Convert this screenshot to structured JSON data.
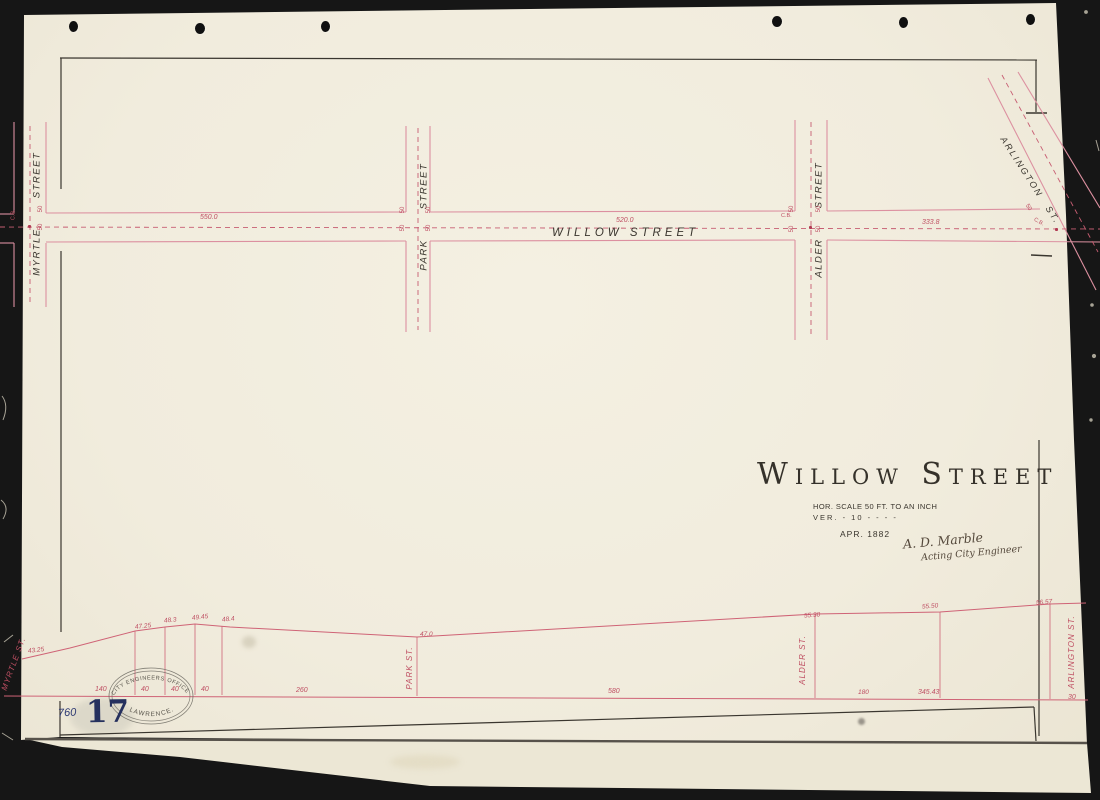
{
  "title_block": {
    "title": "Willow Street",
    "scale_hor": "HOR. SCALE 50 FT. TO AN INCH",
    "scale_ver": "VER.  -  10  -  -  -  -",
    "date": "APR. 1882",
    "signature": "A. D. Marble",
    "signature_role": "Acting City Engineer"
  },
  "plan": {
    "main_street": "WILLOW STREET",
    "cross_streets": [
      "MYRTLE STREET",
      "PARK STREET",
      "ALDER STREET",
      "ARLINGTON ST."
    ],
    "measurements": [
      "550.0",
      "520.0",
      "333.8"
    ],
    "width_mark": "50",
    "catch_basin": "C.B."
  },
  "profile": {
    "street_labels": [
      "MYRTLE ST.",
      "PARK ST.",
      "ALDER ST.",
      "ARLINGTON ST."
    ],
    "elevations": [
      "43.25",
      "47.25",
      "48.3",
      "49.45",
      "48.4",
      "47.0",
      "55.30",
      "55.50",
      "56.57"
    ],
    "distances": [
      "140",
      "40",
      "40",
      "40",
      "260",
      "580",
      "180",
      "345.43",
      "30"
    ]
  },
  "stamp": {
    "arc_top": "CITY ENGINEERS OFFICE",
    "arc_bottom": "LAWRENCE."
  },
  "catalog": {
    "number_handwritten": "760",
    "number_stamped": "17"
  },
  "colors": {
    "paper": "#f2eddf",
    "ink_red": "#c5566b",
    "ink_black": "#37332c",
    "stamp_blue": "#27315e"
  }
}
